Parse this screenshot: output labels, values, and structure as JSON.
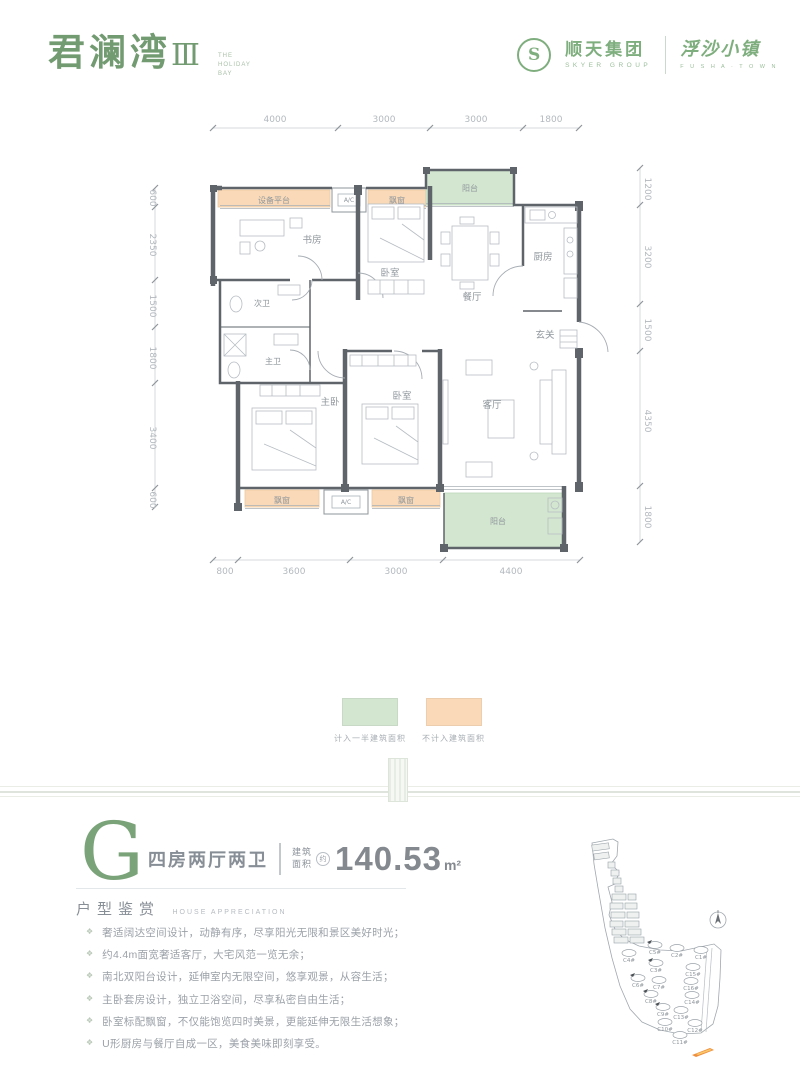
{
  "header": {
    "logo_main": "君澜湾",
    "logo_numeral": "Ⅲ",
    "logo_tagline": "THE HOLIDAY BAY",
    "logo_s": "S",
    "brand_group_name": "顺天集团",
    "brand_group_sub": "SKYER GROUP",
    "brand_town_name": "浮沙小镇",
    "brand_town_sub": "F U S H A · T O W N"
  },
  "floorplan": {
    "dims_top": [
      "4000",
      "3000",
      "3000",
      "1800"
    ],
    "dims_bottom": [
      "800",
      "3600",
      "3000",
      "4400"
    ],
    "dims_left": [
      "600",
      "2350",
      "1500",
      "1800",
      "3400",
      "600"
    ],
    "dims_right": [
      "1200",
      "3200",
      "1500",
      "4350",
      "1800"
    ],
    "rooms": {
      "equip_platform": "设备平台",
      "ac": "A/C",
      "bay_window": "飘窗",
      "balcony": "阳台",
      "study": "书房",
      "bedroom": "卧室",
      "dining": "餐厅",
      "kitchen": "厨房",
      "foyer": "玄关",
      "bath_second": "次卫",
      "bath_master": "主卫",
      "master": "主卧",
      "living": "客厅"
    }
  },
  "legend": {
    "items": [
      {
        "label": "计入一半建筑面积",
        "color": "#d3e6d0"
      },
      {
        "label": "不计入建筑面积",
        "color": "#f9d9b7"
      }
    ]
  },
  "unit": {
    "type_letter": "G",
    "layout_name": "四房两厅两卫",
    "area_label_top": "建筑",
    "area_label_bottom": "面积",
    "area_approx_mark": "约",
    "area_value": "140.53",
    "area_unit": "m²"
  },
  "appreciation": {
    "title": "户型鉴赏",
    "subtitle": "HOUSE APPRECIATION",
    "bullet_icon": "❖",
    "bullets": [
      "奢适阔达空间设计，动静有序，尽享阳光无限和景区美好时光；",
      "约4.4m面宽奢适客厅，大宅风范一览无余；",
      "南北双阳台设计，延伸室内无限空间，悠享观景，从容生活；",
      "主卧套房设计，独立卫浴空间，尽享私密自由生活；",
      "卧室标配飘窗，不仅能饱览四时美景，更能延伸无限生活想象；",
      "U形厨房与餐厅自成一区，美食美味即刻享受。"
    ]
  },
  "sitemap": {
    "buildings": [
      {
        "label": "C5#"
      },
      {
        "label": "C2#"
      },
      {
        "label": "C1#"
      },
      {
        "label": "C4#"
      },
      {
        "label": "C3#"
      },
      {
        "label": "C15#"
      },
      {
        "label": "C6#"
      },
      {
        "label": "C7#"
      },
      {
        "label": "C16#"
      },
      {
        "label": "C8#"
      },
      {
        "label": "C14#"
      },
      {
        "label": "C9#"
      },
      {
        "label": "C13#"
      },
      {
        "label": "C10#"
      },
      {
        "label": "C12#"
      },
      {
        "label": "C11#"
      }
    ]
  },
  "colors": {
    "accent_green": "#739b72",
    "legend_green": "#d3e6d0",
    "legend_orange": "#f9d9b7",
    "wall_gray": "#5f646a",
    "text_gray": "#8b929a",
    "highlight_orange": "#ef8f3e"
  }
}
